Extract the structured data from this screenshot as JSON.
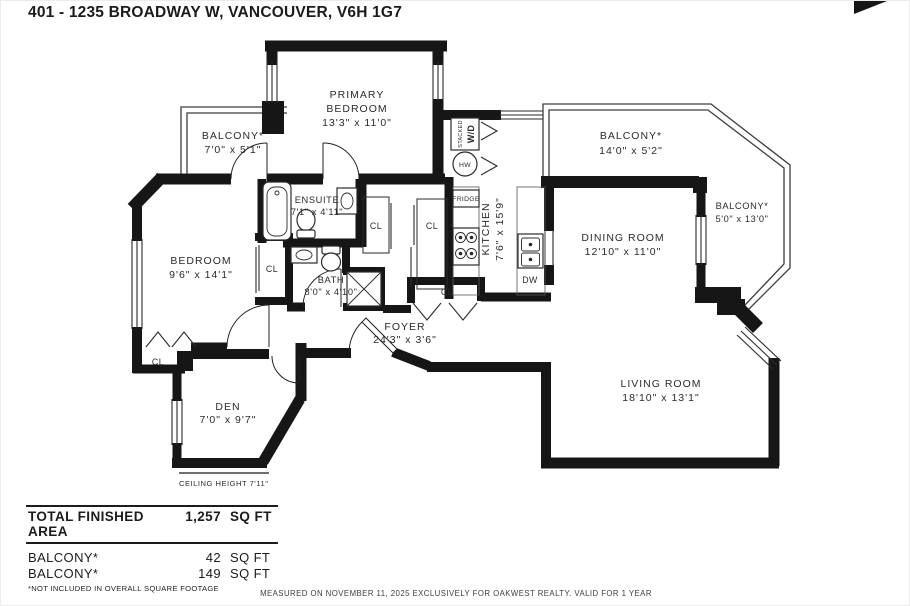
{
  "header": {
    "title": "401 - 1235 BROADWAY W, VANCOUVER, V6H 1G7"
  },
  "rooms": {
    "primary_bedroom": {
      "name_line1": "PRIMARY",
      "name_line2": "BEDROOM",
      "dims": "13'3\" x 11'0\""
    },
    "balcony_top_left": {
      "name": "BALCONY*",
      "dims": "7'0\" x 5'1\""
    },
    "balcony_top_right": {
      "name": "BALCONY*",
      "dims": "14'0\" x 5'2\""
    },
    "balcony_right": {
      "name": "BALCONY*",
      "dims": "5'0\" x 13'0\""
    },
    "kitchen": {
      "name": "KITCHEN",
      "dims": "7'6\" x 15'9\""
    },
    "dining_room": {
      "name": "DINING ROOM",
      "dims": "12'10\" x 11'0\""
    },
    "living_room": {
      "name": "LIVING ROOM",
      "dims": "18'10\" x 13'1\""
    },
    "bedroom": {
      "name": "BEDROOM",
      "dims": "9'6\" x 14'1\""
    },
    "ensuite": {
      "name": "ENSUITE",
      "dims": "7'1\" x 4'11\""
    },
    "bath": {
      "name": "BATH",
      "dims": "8'0\" x 4'10\""
    },
    "foyer": {
      "name": "FOYER",
      "dims": "24'3\" x 3'6\""
    },
    "den": {
      "name": "DEN",
      "dims": "7'0\" x 9'7\""
    }
  },
  "labels": {
    "closet": "CL",
    "fridge": "FRIDGE",
    "dishwasher": "DW",
    "hot_water": "HW",
    "washer_dryer_line1": "STACKED",
    "washer_dryer_line2": "W/D"
  },
  "notes": {
    "ceiling_height": "CEILING HEIGHT 7'11\""
  },
  "summary": {
    "total_label": "TOTAL FINISHED AREA",
    "total_value": "1,257",
    "total_unit": "SQ FT",
    "rows": [
      {
        "label": "BALCONY*",
        "value": "42",
        "unit": "SQ FT"
      },
      {
        "label": "BALCONY*",
        "value": "149",
        "unit": "SQ FT"
      }
    ],
    "footnote": "*NOT INCLUDED IN OVERALL SQUARE FOOTAGE"
  },
  "footer": {
    "disclaimer": "MEASURED ON NOVEMBER 11, 2025 EXCLUSIVELY FOR OAKWEST REALTY. VALID FOR 1 YEAR"
  },
  "colors": {
    "wall": "#161616",
    "text": "#2b2b2b",
    "railing": "#3d3d3d"
  }
}
